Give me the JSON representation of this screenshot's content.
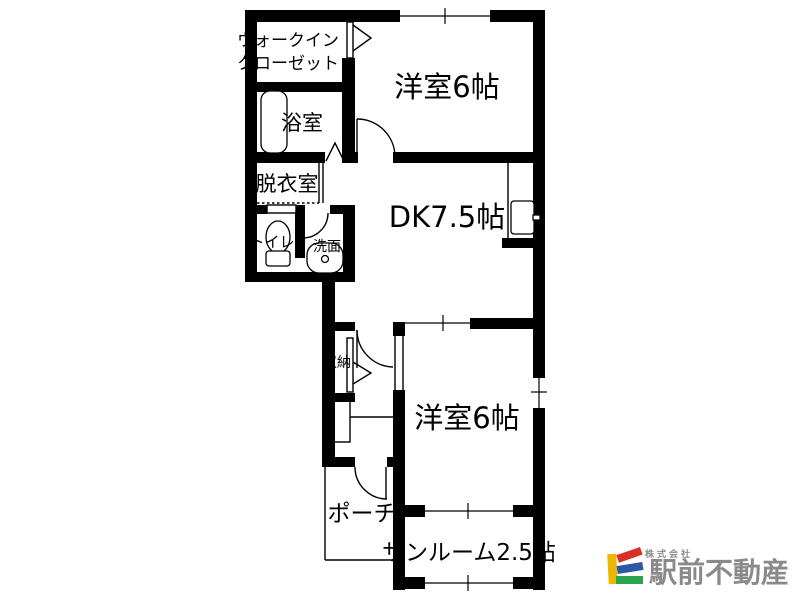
{
  "rooms": {
    "walk_in_closet": {
      "label_line1": "ウォークイン",
      "label_line2": "クローゼット"
    },
    "bedroom_top": {
      "label": "洋室6帖"
    },
    "bathroom": {
      "label": "浴室"
    },
    "dressing_room": {
      "label": "脱衣室"
    },
    "toilet": {
      "label": "トイレ"
    },
    "washbasin": {
      "label": "洗面"
    },
    "dining_kitchen": {
      "label": "DK7.5帖"
    },
    "storage": {
      "label": "収納"
    },
    "bedroom_bottom": {
      "label": "洋室6帖"
    },
    "porch": {
      "label": "ポーチ"
    },
    "sunroom": {
      "label": "サンルーム2.5帖"
    }
  },
  "logo": {
    "company_prefix": "株式会社",
    "company_name": "駅前不動産",
    "text_color": "#8a8a8a",
    "mark_colors": {
      "yellow": "#edb600",
      "red": "#d93025",
      "blue": "#2b57a5",
      "green": "#28a44e"
    }
  },
  "colors": {
    "wall": "#000000",
    "background": "#ffffff"
  }
}
